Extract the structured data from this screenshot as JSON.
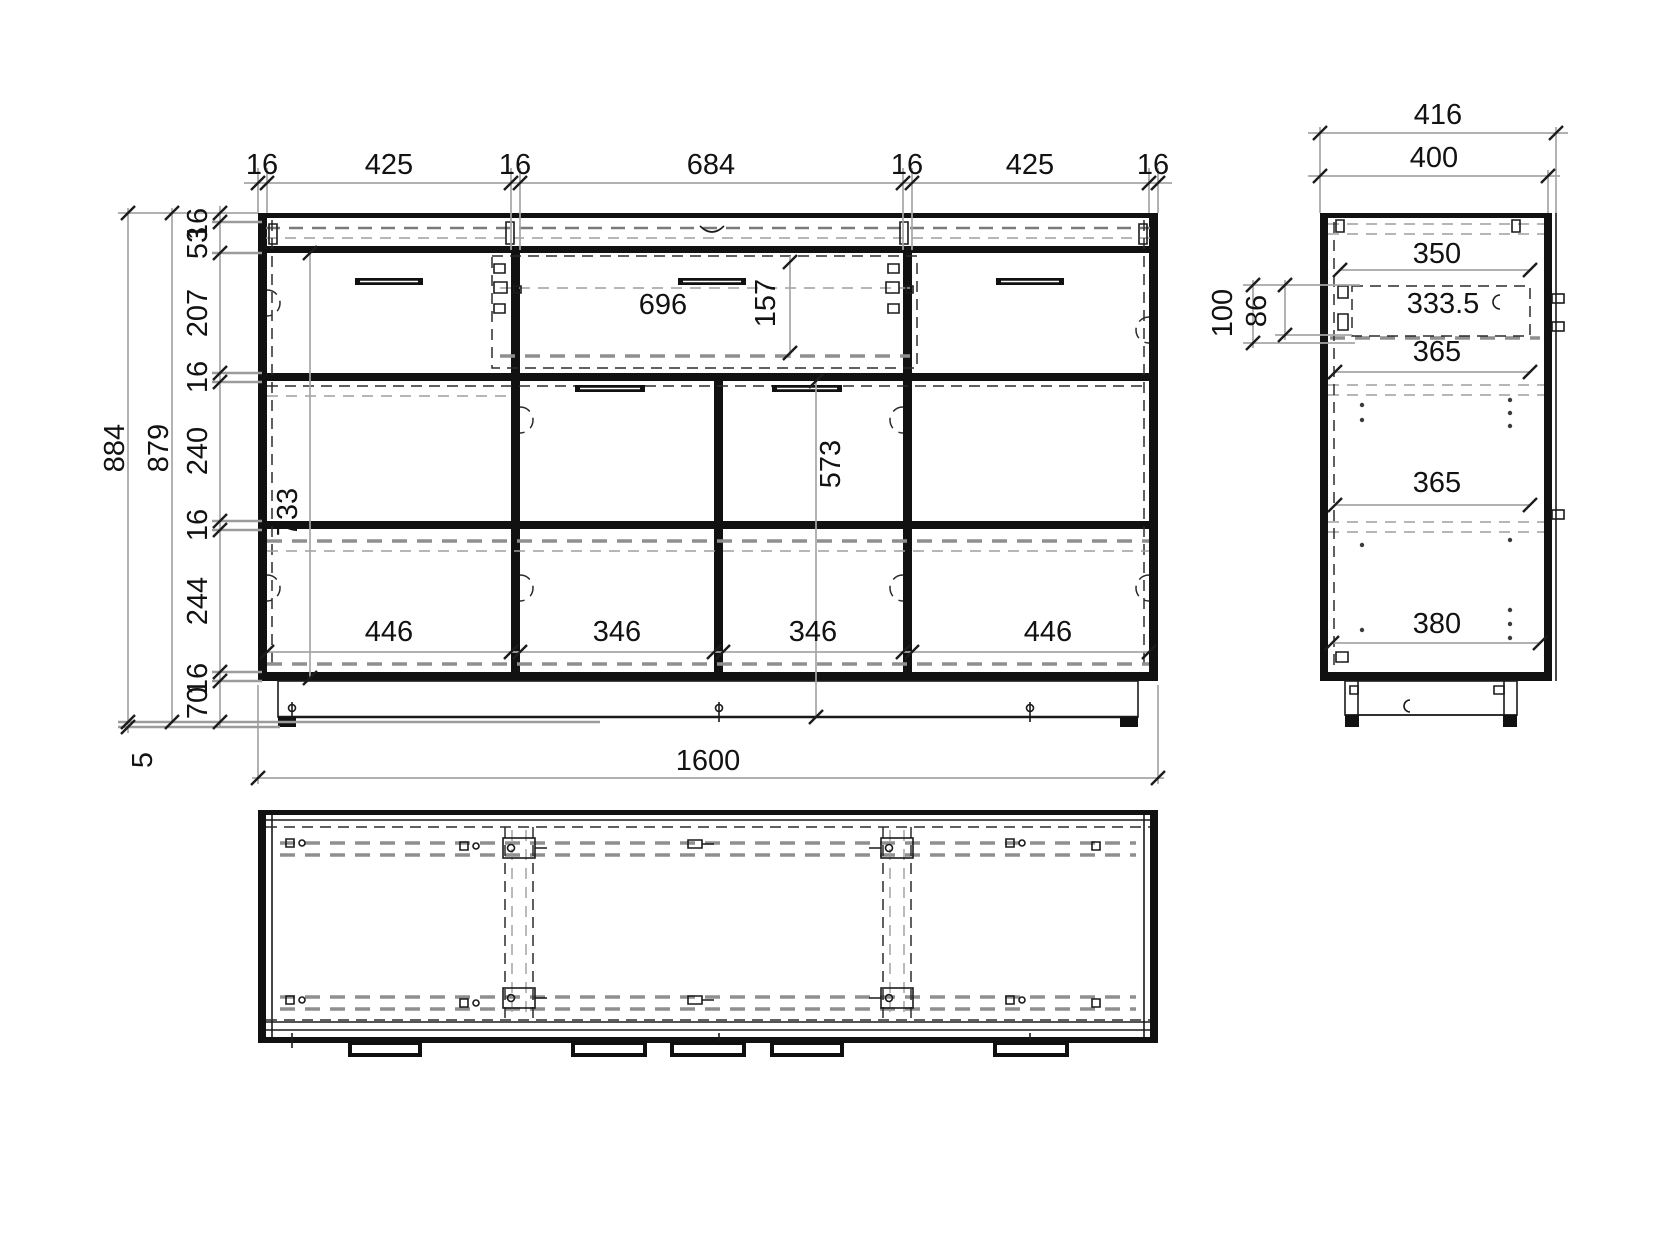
{
  "front_view": {
    "top_chain": [
      "16",
      "425",
      "16",
      "684",
      "16",
      "425",
      "16"
    ],
    "left_chain": [
      "16",
      "53",
      "207",
      "16",
      "240",
      "16",
      "244",
      "16",
      "70"
    ],
    "overall_height": "884",
    "carcass_height": "879",
    "foot_height": "5",
    "overall_width": "1600",
    "center_drawer_width": "696",
    "drawer_front_height": "157",
    "left_section_height": "733",
    "door_section_height": "573",
    "bottom_cell_widths": [
      "446",
      "346",
      "346",
      "446"
    ]
  },
  "side_view": {
    "overall_depth": "416",
    "carcass_depth": "400",
    "top_panel_depth": "350",
    "drawer_depth": "333.5",
    "shelf_depths": [
      "365",
      "365"
    ],
    "bottom_panel_depth": "380",
    "drawer_top_offset": "100",
    "drawer_box_height": "86"
  },
  "colors": {
    "line": "#111111",
    "dimension": "#a6a6a6",
    "background": "#ffffff"
  }
}
